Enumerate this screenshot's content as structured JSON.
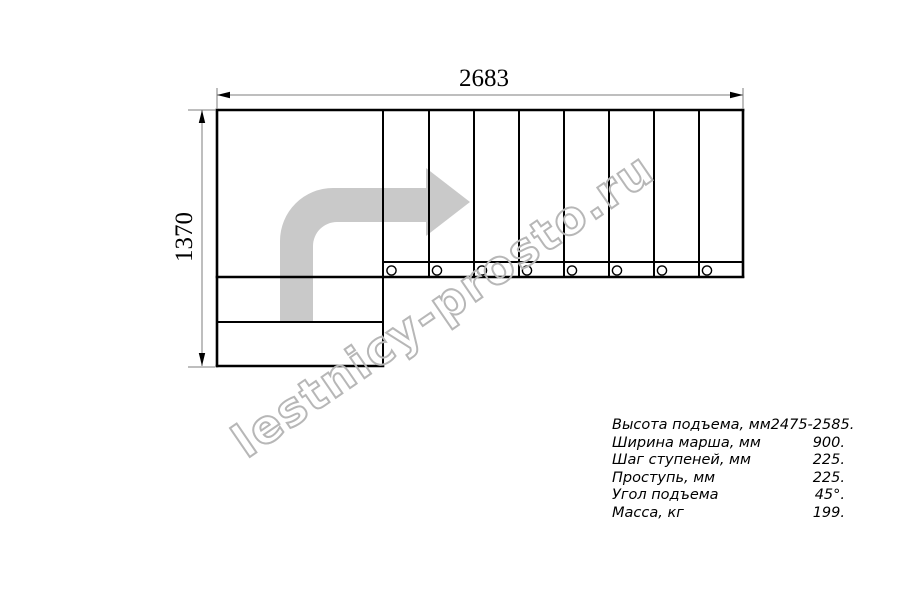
{
  "drawing": {
    "dimension_width_mm": "2683",
    "dimension_height_mm": "1370",
    "watermark": "lestnicy-prosto.ru",
    "tread_count": 8,
    "fastener_count": 8
  },
  "specs": {
    "rows": [
      {
        "label": "Высота подъема, мм",
        "value": "2475-2585."
      },
      {
        "label": "Ширина марша, мм",
        "value": "900."
      },
      {
        "label": "Шаг ступеней, мм",
        "value": "225."
      },
      {
        "label": "Проступь, мм",
        "value": "225."
      },
      {
        "label": "Угол подъема",
        "value": "45°."
      },
      {
        "label": "Масса, кг",
        "value": "199."
      }
    ]
  },
  "colors": {
    "line": "#000000",
    "dim": "#7d7d7d",
    "arrow": "#c9c9c9",
    "watermark": "#b7b7b7",
    "bg": "#ffffff"
  }
}
